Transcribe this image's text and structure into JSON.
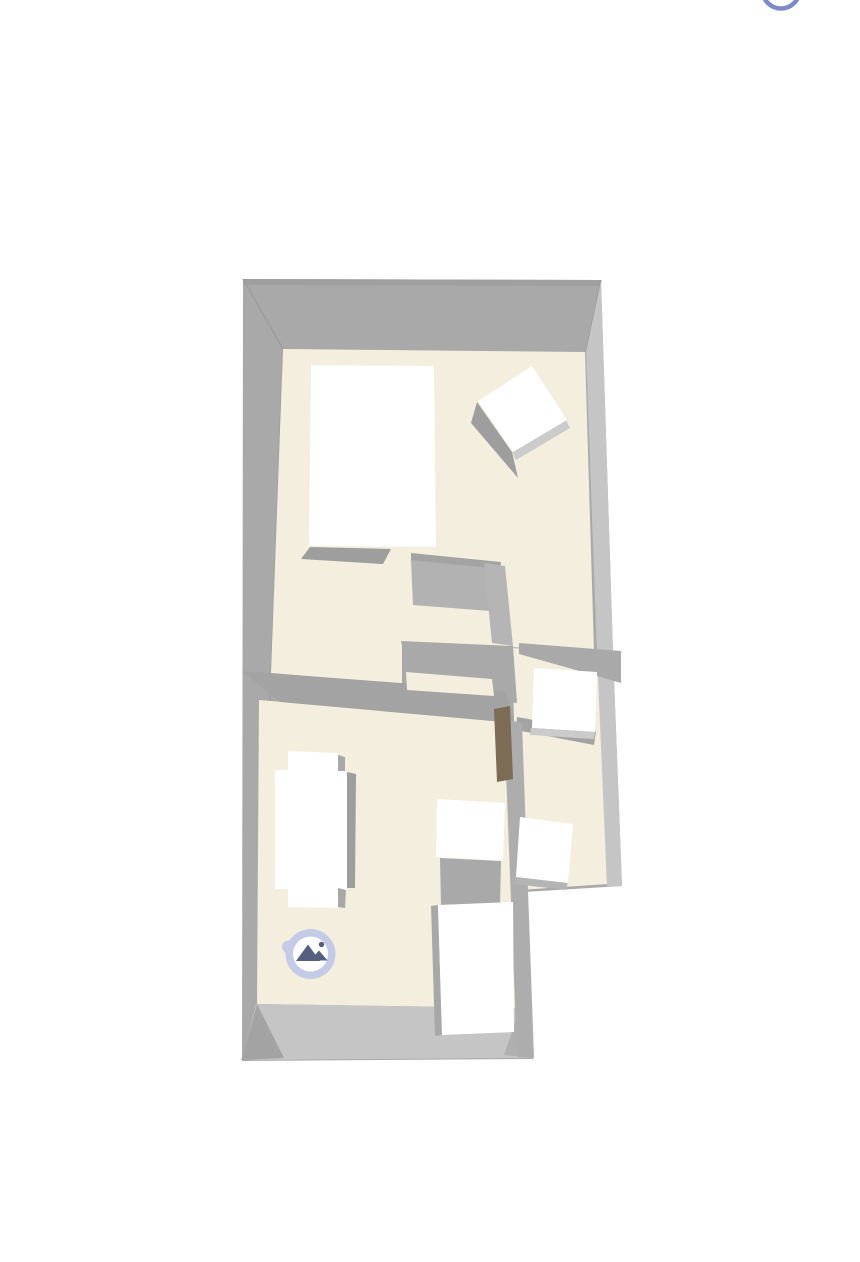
{
  "viewer": {
    "background_color": "#ffffff",
    "top_button": {
      "icon": "partial-circle-button",
      "stroke_color": "#7e89c8"
    },
    "photo_marker": {
      "icon": "mountains-photo-icon",
      "ring_color": "#c5cae7",
      "center_color": "#ffffff",
      "icon_color": "#565e80"
    },
    "floorplan": {
      "floor_color": "#f4eedf",
      "wall_color": "#a9a9a9",
      "wall_light_color": "#c5c5c5",
      "furniture_color": "#ffffff",
      "furniture_shadow_color": "#9e9e9e",
      "door_color": "#7c6b55"
    }
  }
}
